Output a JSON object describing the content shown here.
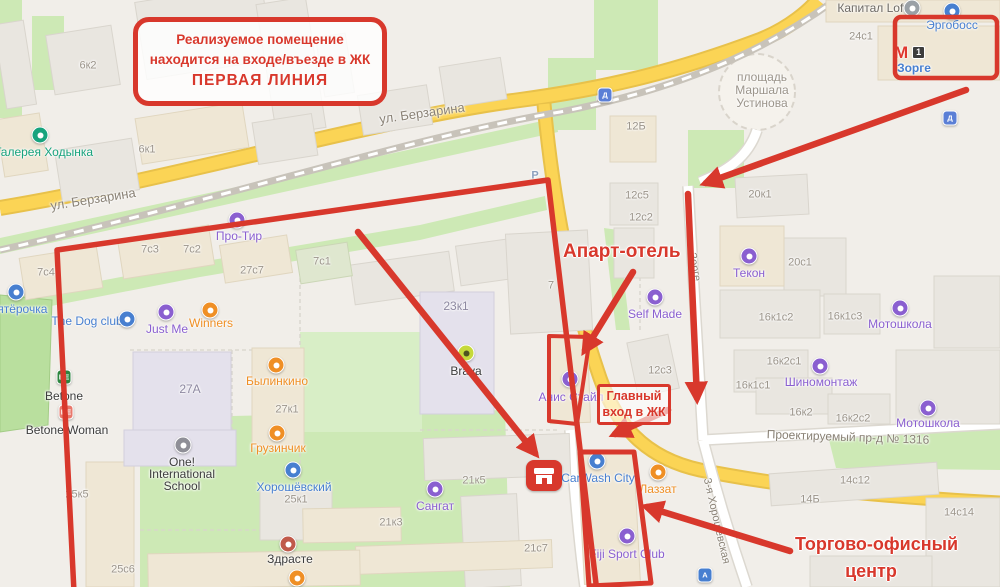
{
  "annotations": {
    "accent_color": "#d8382c",
    "main_note": {
      "line1": "Реализуемое помещение",
      "line2": "находится на входе/въезде в ЖК",
      "line3": "ПЕРВАЯ ЛИНИЯ"
    },
    "apart_hotel_label": "Апарт-отель",
    "main_entrance": {
      "line1": "Главный",
      "line2": "вход в ЖК"
    },
    "office_center": {
      "line1": "Торгово-офисный",
      "line2": "центр"
    }
  },
  "metro": {
    "symbol": "М",
    "name": "Зорге",
    "route_badge": "1"
  },
  "map_texts": [
    {
      "t": "ул. Берзарина",
      "x": 93,
      "y": 199,
      "c": "#8a8276",
      "s": 13,
      "r": -9
    },
    {
      "t": "ул. Берзарина",
      "x": 422,
      "y": 113,
      "c": "#8a8276",
      "s": 13,
      "r": -8
    },
    {
      "t": "площадь",
      "x": 762,
      "y": 77,
      "c": "#9b948a",
      "s": 12
    },
    {
      "t": "Маршала",
      "x": 762,
      "y": 90,
      "c": "#9b948a",
      "s": 12
    },
    {
      "t": "Устинова",
      "x": 762,
      "y": 103,
      "c": "#9b948a",
      "s": 12
    },
    {
      "t": "Проектируемый пр-д № 1316",
      "x": 848,
      "y": 437,
      "c": "#8a8276",
      "s": 12,
      "r": 2
    },
    {
      "t": "3-я Хорошёвская",
      "x": 716,
      "y": 521,
      "c": "#8a8276",
      "s": 11,
      "r": 77
    },
    {
      "t": "Зорге",
      "x": 694,
      "y": 267,
      "c": "#8a8276",
      "s": 11,
      "r": 80
    },
    {
      "t": "Р",
      "x": 535,
      "y": 176,
      "c": "#8da0bd",
      "s": 11,
      "w": 700
    },
    {
      "t": "6к2",
      "x": 88,
      "y": 66
    },
    {
      "t": "6к1",
      "x": 147,
      "y": 150
    },
    {
      "t": "12Б",
      "x": 636,
      "y": 127
    },
    {
      "t": "12с5",
      "x": 637,
      "y": 196
    },
    {
      "t": "12с2",
      "x": 641,
      "y": 218
    },
    {
      "t": "12с3",
      "x": 660,
      "y": 371
    },
    {
      "t": "20к1",
      "x": 760,
      "y": 195
    },
    {
      "t": "20с1",
      "x": 800,
      "y": 263
    },
    {
      "t": "24с1",
      "x": 861,
      "y": 37
    },
    {
      "t": "7с4",
      "x": 46,
      "y": 273
    },
    {
      "t": "7с3",
      "x": 150,
      "y": 250
    },
    {
      "t": "7с2",
      "x": 192,
      "y": 250
    },
    {
      "t": "27с7",
      "x": 252,
      "y": 271
    },
    {
      "t": "7с1",
      "x": 322,
      "y": 262
    },
    {
      "t": "27А",
      "x": 190,
      "y": 389,
      "c": "#8d88a0",
      "s": 12
    },
    {
      "t": "27к1",
      "x": 287,
      "y": 410
    },
    {
      "t": "23к1",
      "x": 456,
      "y": 306,
      "c": "#8d88a0",
      "s": 12
    },
    {
      "t": "7",
      "x": 551,
      "y": 286
    },
    {
      "t": "21к5",
      "x": 474,
      "y": 481
    },
    {
      "t": "21к3",
      "x": 391,
      "y": 523
    },
    {
      "t": "21с7",
      "x": 536,
      "y": 549
    },
    {
      "t": "25к5",
      "x": 77,
      "y": 495
    },
    {
      "t": "25к1",
      "x": 296,
      "y": 500
    },
    {
      "t": "25с6",
      "x": 123,
      "y": 570
    },
    {
      "t": "16к1с2",
      "x": 776,
      "y": 318
    },
    {
      "t": "16к1с3",
      "x": 845,
      "y": 317
    },
    {
      "t": "16к2с1",
      "x": 784,
      "y": 362
    },
    {
      "t": "16к1с1",
      "x": 753,
      "y": 386
    },
    {
      "t": "16к2",
      "x": 801,
      "y": 413
    },
    {
      "t": "16к2с2",
      "x": 853,
      "y": 419
    },
    {
      "t": "14с12",
      "x": 855,
      "y": 481
    },
    {
      "t": "14Б",
      "x": 810,
      "y": 500
    },
    {
      "t": "14с14",
      "x": 959,
      "y": 513
    },
    {
      "t": "Галерея Ходынка",
      "x": 44,
      "y": 152,
      "c": "#17a37d",
      "s": 12
    },
    {
      "t": "Пятёрочка",
      "x": 18,
      "y": 309,
      "c": "#477fd0",
      "s": 12
    },
    {
      "t": "The Dog club",
      "x": 87,
      "y": 321,
      "c": "#477fd0",
      "s": 12
    },
    {
      "t": "Just Me",
      "x": 167,
      "y": 329,
      "c": "#8a5fd0",
      "s": 12
    },
    {
      "t": "Winners",
      "x": 211,
      "y": 323,
      "c": "#ef8f25",
      "s": 12
    },
    {
      "t": "Betone",
      "x": 64,
      "y": 396,
      "c": "#3c3c3c",
      "s": 12
    },
    {
      "t": "Betone Woman",
      "x": 67,
      "y": 430,
      "c": "#3c3c3c",
      "s": 12
    },
    {
      "t": "Былинкино",
      "x": 277,
      "y": 381,
      "c": "#ef8f25",
      "s": 12
    },
    {
      "t": "Грузинчик",
      "x": 278,
      "y": 448,
      "c": "#ef8f25",
      "s": 12
    },
    {
      "t": "Про-Тир",
      "x": 239,
      "y": 236,
      "c": "#8a5fd0",
      "s": 12
    },
    {
      "t": "One!",
      "x": 182,
      "y": 462,
      "c": "#3c3c3c",
      "s": 12
    },
    {
      "t": "International",
      "x": 182,
      "y": 474,
      "c": "#3c3c3c",
      "s": 12
    },
    {
      "t": "School",
      "x": 182,
      "y": 486,
      "c": "#3c3c3c",
      "s": 12
    },
    {
      "t": "Хорошёвский",
      "x": 294,
      "y": 487,
      "c": "#477fd0",
      "s": 12
    },
    {
      "t": "Здрасте",
      "x": 290,
      "y": 559,
      "c": "#3c3c3c",
      "s": 12
    },
    {
      "t": "Сангат",
      "x": 435,
      "y": 506,
      "c": "#8a5fd0",
      "s": 12
    },
    {
      "t": "Анис Стайл",
      "x": 571,
      "y": 397,
      "c": "#8a5fd0",
      "s": 12
    },
    {
      "t": "Self Made",
      "x": 655,
      "y": 314,
      "c": "#8a5fd0",
      "s": 12
    },
    {
      "t": "CarWash City",
      "x": 598,
      "y": 478,
      "c": "#477fd0",
      "s": 12
    },
    {
      "t": "Лаззат",
      "x": 658,
      "y": 489,
      "c": "#ef8f25",
      "s": 12
    },
    {
      "t": "Fiji Sport Club",
      "x": 627,
      "y": 554,
      "c": "#8a5fd0",
      "s": 12
    },
    {
      "t": "Текон",
      "x": 749,
      "y": 273,
      "c": "#8a5fd0",
      "s": 12
    },
    {
      "t": "Мотошкола",
      "x": 900,
      "y": 324,
      "c": "#8a5fd0",
      "s": 12
    },
    {
      "t": "Шиномонтаж",
      "x": 821,
      "y": 382,
      "c": "#8a5fd0",
      "s": 12
    },
    {
      "t": "Мотошкола",
      "x": 928,
      "y": 423,
      "c": "#8a5fd0",
      "s": 12
    },
    {
      "t": "Капитал Loft",
      "x": 872,
      "y": 8,
      "c": "#6e6a64",
      "s": 12
    },
    {
      "t": "Эргобосс",
      "x": 952,
      "y": 25,
      "c": "#477fd0",
      "s": 12
    },
    {
      "t": "Зорге",
      "x": 914,
      "y": 68,
      "c": "#477fd0",
      "s": 12,
      "w": 700
    },
    {
      "t": "Brava",
      "x": 466,
      "y": 371,
      "c": "#3c3c3c",
      "s": 12
    }
  ],
  "poi_icons": [
    {
      "n": "museum-icon",
      "x": 40,
      "y": 135,
      "bg": "#17a37d"
    },
    {
      "n": "pyaterochka-icon",
      "x": 16,
      "y": 292,
      "bg": "#477fd0"
    },
    {
      "n": "dog-club-icon",
      "x": 127,
      "y": 319,
      "bg": "#477fd0"
    },
    {
      "n": "just-me-icon",
      "x": 166,
      "y": 312,
      "bg": "#8a5fd0"
    },
    {
      "n": "winners-icon",
      "x": 210,
      "y": 310,
      "bg": "#ef8f25"
    },
    {
      "n": "betone-icon",
      "x": 64,
      "y": 377,
      "bg": "#2e8540",
      "shape": "square",
      "g": "BE"
    },
    {
      "n": "betone-woman-icon",
      "x": 66,
      "y": 412,
      "bg": "#e8796c",
      "shape": "square",
      "g": "BE"
    },
    {
      "n": "bylinkino-icon",
      "x": 276,
      "y": 365,
      "bg": "#ef8f25"
    },
    {
      "n": "gruzinchik-icon",
      "x": 277,
      "y": 433,
      "bg": "#ef8f25"
    },
    {
      "n": "pro-tir-icon",
      "x": 237,
      "y": 220,
      "bg": "#8a5fd0"
    },
    {
      "n": "school-icon",
      "x": 183,
      "y": 445,
      "bg": "#8f8f97"
    },
    {
      "n": "horoshevsky-icon",
      "x": 293,
      "y": 470,
      "bg": "#477fd0"
    },
    {
      "n": "zdraste-icon",
      "x": 288,
      "y": 544,
      "bg": "#c05a4a"
    },
    {
      "n": "food-icon",
      "x": 297,
      "y": 578,
      "bg": "#ef8f25"
    },
    {
      "n": "sangat-icon",
      "x": 435,
      "y": 489,
      "bg": "#8a5fd0"
    },
    {
      "n": "anis-style-icon",
      "x": 570,
      "y": 379,
      "bg": "#8a5fd0"
    },
    {
      "n": "self-made-icon",
      "x": 655,
      "y": 297,
      "bg": "#8a5fd0"
    },
    {
      "n": "carwash-icon",
      "x": 597,
      "y": 461,
      "bg": "#477fd0"
    },
    {
      "n": "lazzat-icon",
      "x": 658,
      "y": 472,
      "bg": "#ef8f25"
    },
    {
      "n": "fiji-icon",
      "x": 627,
      "y": 536,
      "bg": "#8a5fd0"
    },
    {
      "n": "tekon-icon",
      "x": 749,
      "y": 256,
      "bg": "#8a5fd0"
    },
    {
      "n": "motoshkola-icon",
      "x": 900,
      "y": 308,
      "bg": "#8a5fd0"
    },
    {
      "n": "shinomontazh-icon",
      "x": 820,
      "y": 366,
      "bg": "#8a5fd0"
    },
    {
      "n": "motoshkola-icon",
      "x": 928,
      "y": 408,
      "bg": "#8a5fd0"
    },
    {
      "n": "kapital-loft-icon",
      "x": 912,
      "y": 8,
      "bg": "#9aa0a6"
    },
    {
      "n": "ergoboss-icon",
      "x": 952,
      "y": 11,
      "bg": "#477fd0"
    },
    {
      "n": "brava-icon",
      "x": 466,
      "y": 353,
      "bg": "#c6d93a",
      "dc": "#4e5420"
    },
    {
      "n": "rail-station-icon",
      "x": 605,
      "y": 95,
      "bg": "#5b7fd6",
      "shape": "square",
      "g": "Д"
    },
    {
      "n": "rail-station-icon",
      "x": 950,
      "y": 118,
      "bg": "#5b7fd6",
      "shape": "square",
      "g": "Д"
    },
    {
      "n": "bus-stop-icon",
      "x": 705,
      "y": 575,
      "bg": "#477fd0",
      "shape": "square",
      "g": "А"
    }
  ]
}
